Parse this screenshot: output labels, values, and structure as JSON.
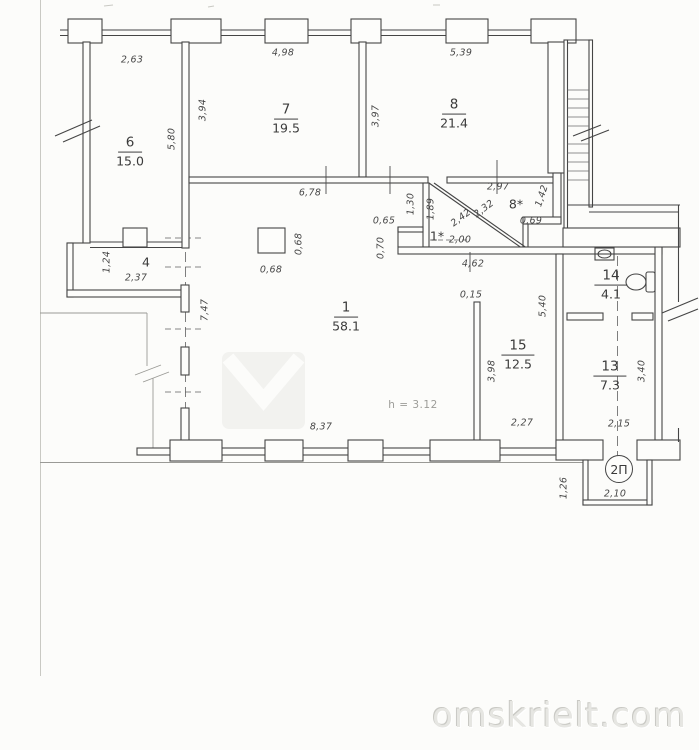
{
  "plan": {
    "rooms": {
      "r1": {
        "num": "1",
        "area": "58.1"
      },
      "r6": {
        "num": "6",
        "area": "15.0"
      },
      "r7": {
        "num": "7",
        "area": "19.5"
      },
      "r8": {
        "num": "8",
        "area": "21.4"
      },
      "r13": {
        "num": "13",
        "area": "7.3"
      },
      "r14": {
        "num": "14",
        "area": "4.1"
      },
      "r15": {
        "num": "15",
        "area": "12.5"
      },
      "r4": {
        "num": "4"
      },
      "r1star": {
        "num": "1*"
      },
      "r8star": {
        "num": "8*"
      }
    },
    "dims": {
      "top_room6": "2,63",
      "top_room7": "4,98",
      "top_room8": "5,39",
      "room7_left": "3,94",
      "room6_right": "5,80",
      "room8_left": "3,97",
      "corridor_width": "6,78",
      "r8star_top": "2,97",
      "r8star_right": "1,42",
      "v130": "1,30",
      "v189": "1,89",
      "diag232": "2,32",
      "diag242": "2,42",
      "w065": "0,65",
      "w069": "0,69",
      "w200": "2,00",
      "v070": "0,70",
      "w462": "4,62",
      "room4_left": "1,24",
      "room4_width": "2,37",
      "column_side": "0,68",
      "column_bottom": "0,68",
      "hall_left": "7,47",
      "thin_wall": "0,15",
      "right_wall": "5,40",
      "wall15_len": "3,98",
      "room15_bottom": "2,27",
      "hall_bottom": "8,37",
      "room13_right": "3,40",
      "room13_bottom": "2,15",
      "vestibule_width": "2,10",
      "vestibule_left": "1,26"
    },
    "notes": {
      "ceiling_height": "h = 3.12"
    },
    "entrance": {
      "label": "2П"
    },
    "icons": {
      "toilet": "toilet-plan-icon",
      "sink": "sink-plan-icon",
      "stairs": "staircase-icon",
      "logo": "watermark-logo-chevron"
    },
    "colors": {
      "wall": "#454545",
      "paper": "#fcfcfa",
      "faint": "#9a9a96",
      "watermark": "#e6e6e2"
    }
  },
  "watermark": {
    "site": "omskrielt.com"
  }
}
